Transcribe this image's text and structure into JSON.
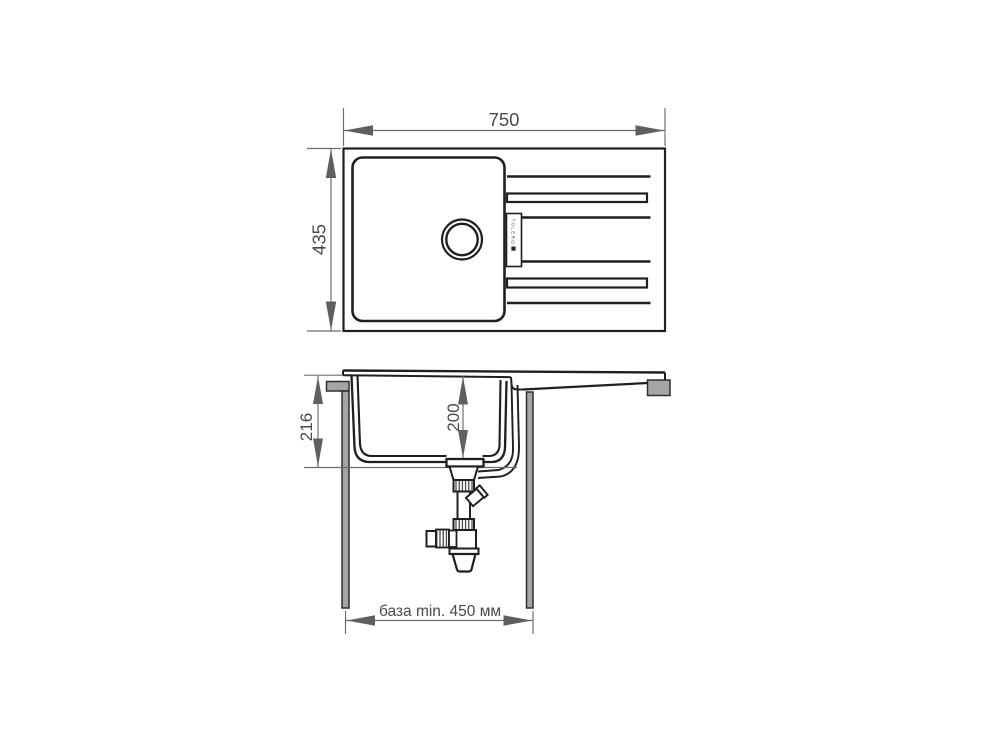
{
  "canvas": {
    "background": "#ffffff"
  },
  "drawing": {
    "kind": "kitchen-sink-installation-diagram",
    "brand_label": "TOLERO",
    "top_view": {
      "width_mm": "750",
      "depth_mm": "435"
    },
    "section_view": {
      "total_depth_mm": "216",
      "bowl_depth_mm": "200",
      "cabinet_base_min": "база min. 450 мм"
    },
    "colors": {
      "outline": "#1f1f1f",
      "dimension_line": "#6b6b6b",
      "dimension_text": "#4a4a4a",
      "cabinet_fill": "#a5a5a5",
      "background": "#ffffff"
    }
  }
}
